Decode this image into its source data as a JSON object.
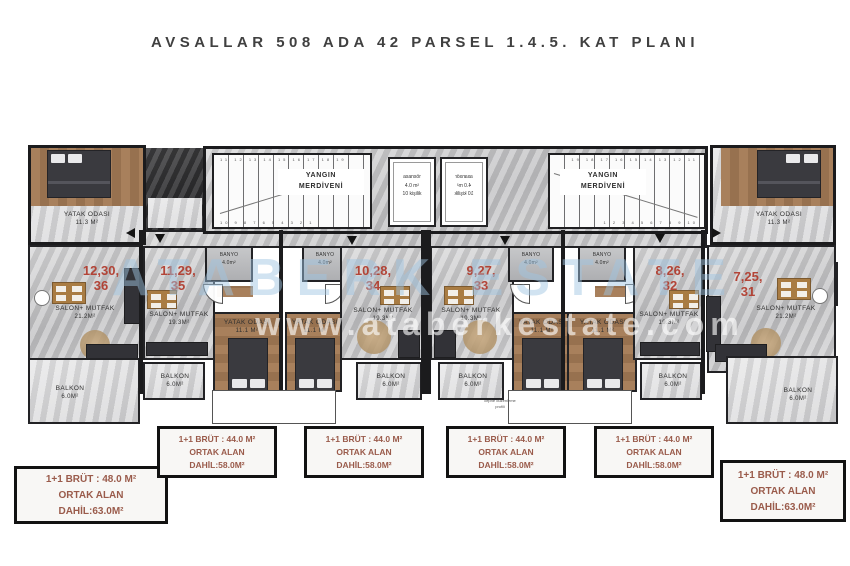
{
  "title": "AVSALLAR 508 ADA 42 PARSEL 1.4.5. KAT PLANI",
  "watermark": {
    "brand": "ATABERK ESTATE",
    "url": "www.ataberkestate.com"
  },
  "core": {
    "fire_stairs": {
      "line1": "YANGIN",
      "line2": "MERDİVENİ"
    },
    "stairs_left": {
      "numbers_top": "11 12 13 14 15 16 17 18 19",
      "numbers_bottom": "10 9 8 7 6 5 4 3 2 1"
    },
    "stairs_right": {
      "numbers_top": "19 18 17 16 15 14 13 12 11",
      "numbers_bottom": "1 2 3 4 5 6 7 8 9 10"
    },
    "elevator": {
      "name": "asansör",
      "area": "4.0 m²",
      "capacity": "10 kişilik"
    }
  },
  "corner_bedroom": {
    "name": "YATAK ODASI",
    "area": "11.3 M²"
  },
  "corner_bath": {
    "name": "BANYO",
    "area": "5.1m²"
  },
  "balcony": {
    "name": "BALKON",
    "area": "6.0M²"
  },
  "small_label": {
    "line1": "cephe düzenleme",
    "line2": "profili"
  },
  "units": [
    {
      "id": "36",
      "no_line1": "12,30,",
      "no_line2": "36",
      "salon": "SALON+ MUTFAK",
      "salon_area": "21.2M²"
    },
    {
      "id": "35",
      "no_line1": "11,29,",
      "no_line2": "35",
      "salon": "SALON+ MUTFAK",
      "salon_area": "19.3M²",
      "bedroom": "YATAK ODASI",
      "bedroom_area": "11.1 M²",
      "bath": "BANYO",
      "bath_area": "4.0m²"
    },
    {
      "id": "34",
      "no_line1": "10,28,",
      "no_line2": "34",
      "salon": "SALON+ MUTFAK",
      "salon_area": "19.3M²",
      "bedroom": "YATAK ODASI",
      "bedroom_area": "11.1 M²",
      "bath": "BANYO",
      "bath_area": "4.0m²"
    },
    {
      "id": "33",
      "no_line1": "9,27,",
      "no_line2": "33",
      "salon": "SALON+ MUTFAK",
      "salon_area": "19.3M²",
      "bedroom": "YATAK ODASI",
      "bedroom_area": "11.1 M²",
      "bath": "BANYO",
      "bath_area": "4.0m²"
    },
    {
      "id": "32",
      "no_line1": "8,26,",
      "no_line2": "32",
      "salon": "SALON+ MUTFAK",
      "salon_area": "19.3M²",
      "bedroom": "YATAK ODASI",
      "bedroom_area": "11.1 M²",
      "bath": "BANYO",
      "bath_area": "4.0m²"
    },
    {
      "id": "31",
      "no_line1": "7,25,",
      "no_line2": "31",
      "salon": "SALON+ MUTFAK",
      "salon_area": "21.2M²"
    }
  ],
  "legend": {
    "end_unit": {
      "line1": "1+1 BRÜT : 48.0 M²",
      "line2": "ORTAK ALAN",
      "line3": "DAHİL:63.0M²"
    },
    "mid_unit": {
      "line1": "1+1 BRÜT : 44.0 M²",
      "line2": "ORTAK ALAN",
      "line3": "DAHİL:58.0M²"
    }
  },
  "colors": {
    "unit_number": "#b0382a",
    "legend_text": "#9a5b4b",
    "wall": "#1b1b1d",
    "watermark_blue": "#9ec5e2"
  }
}
